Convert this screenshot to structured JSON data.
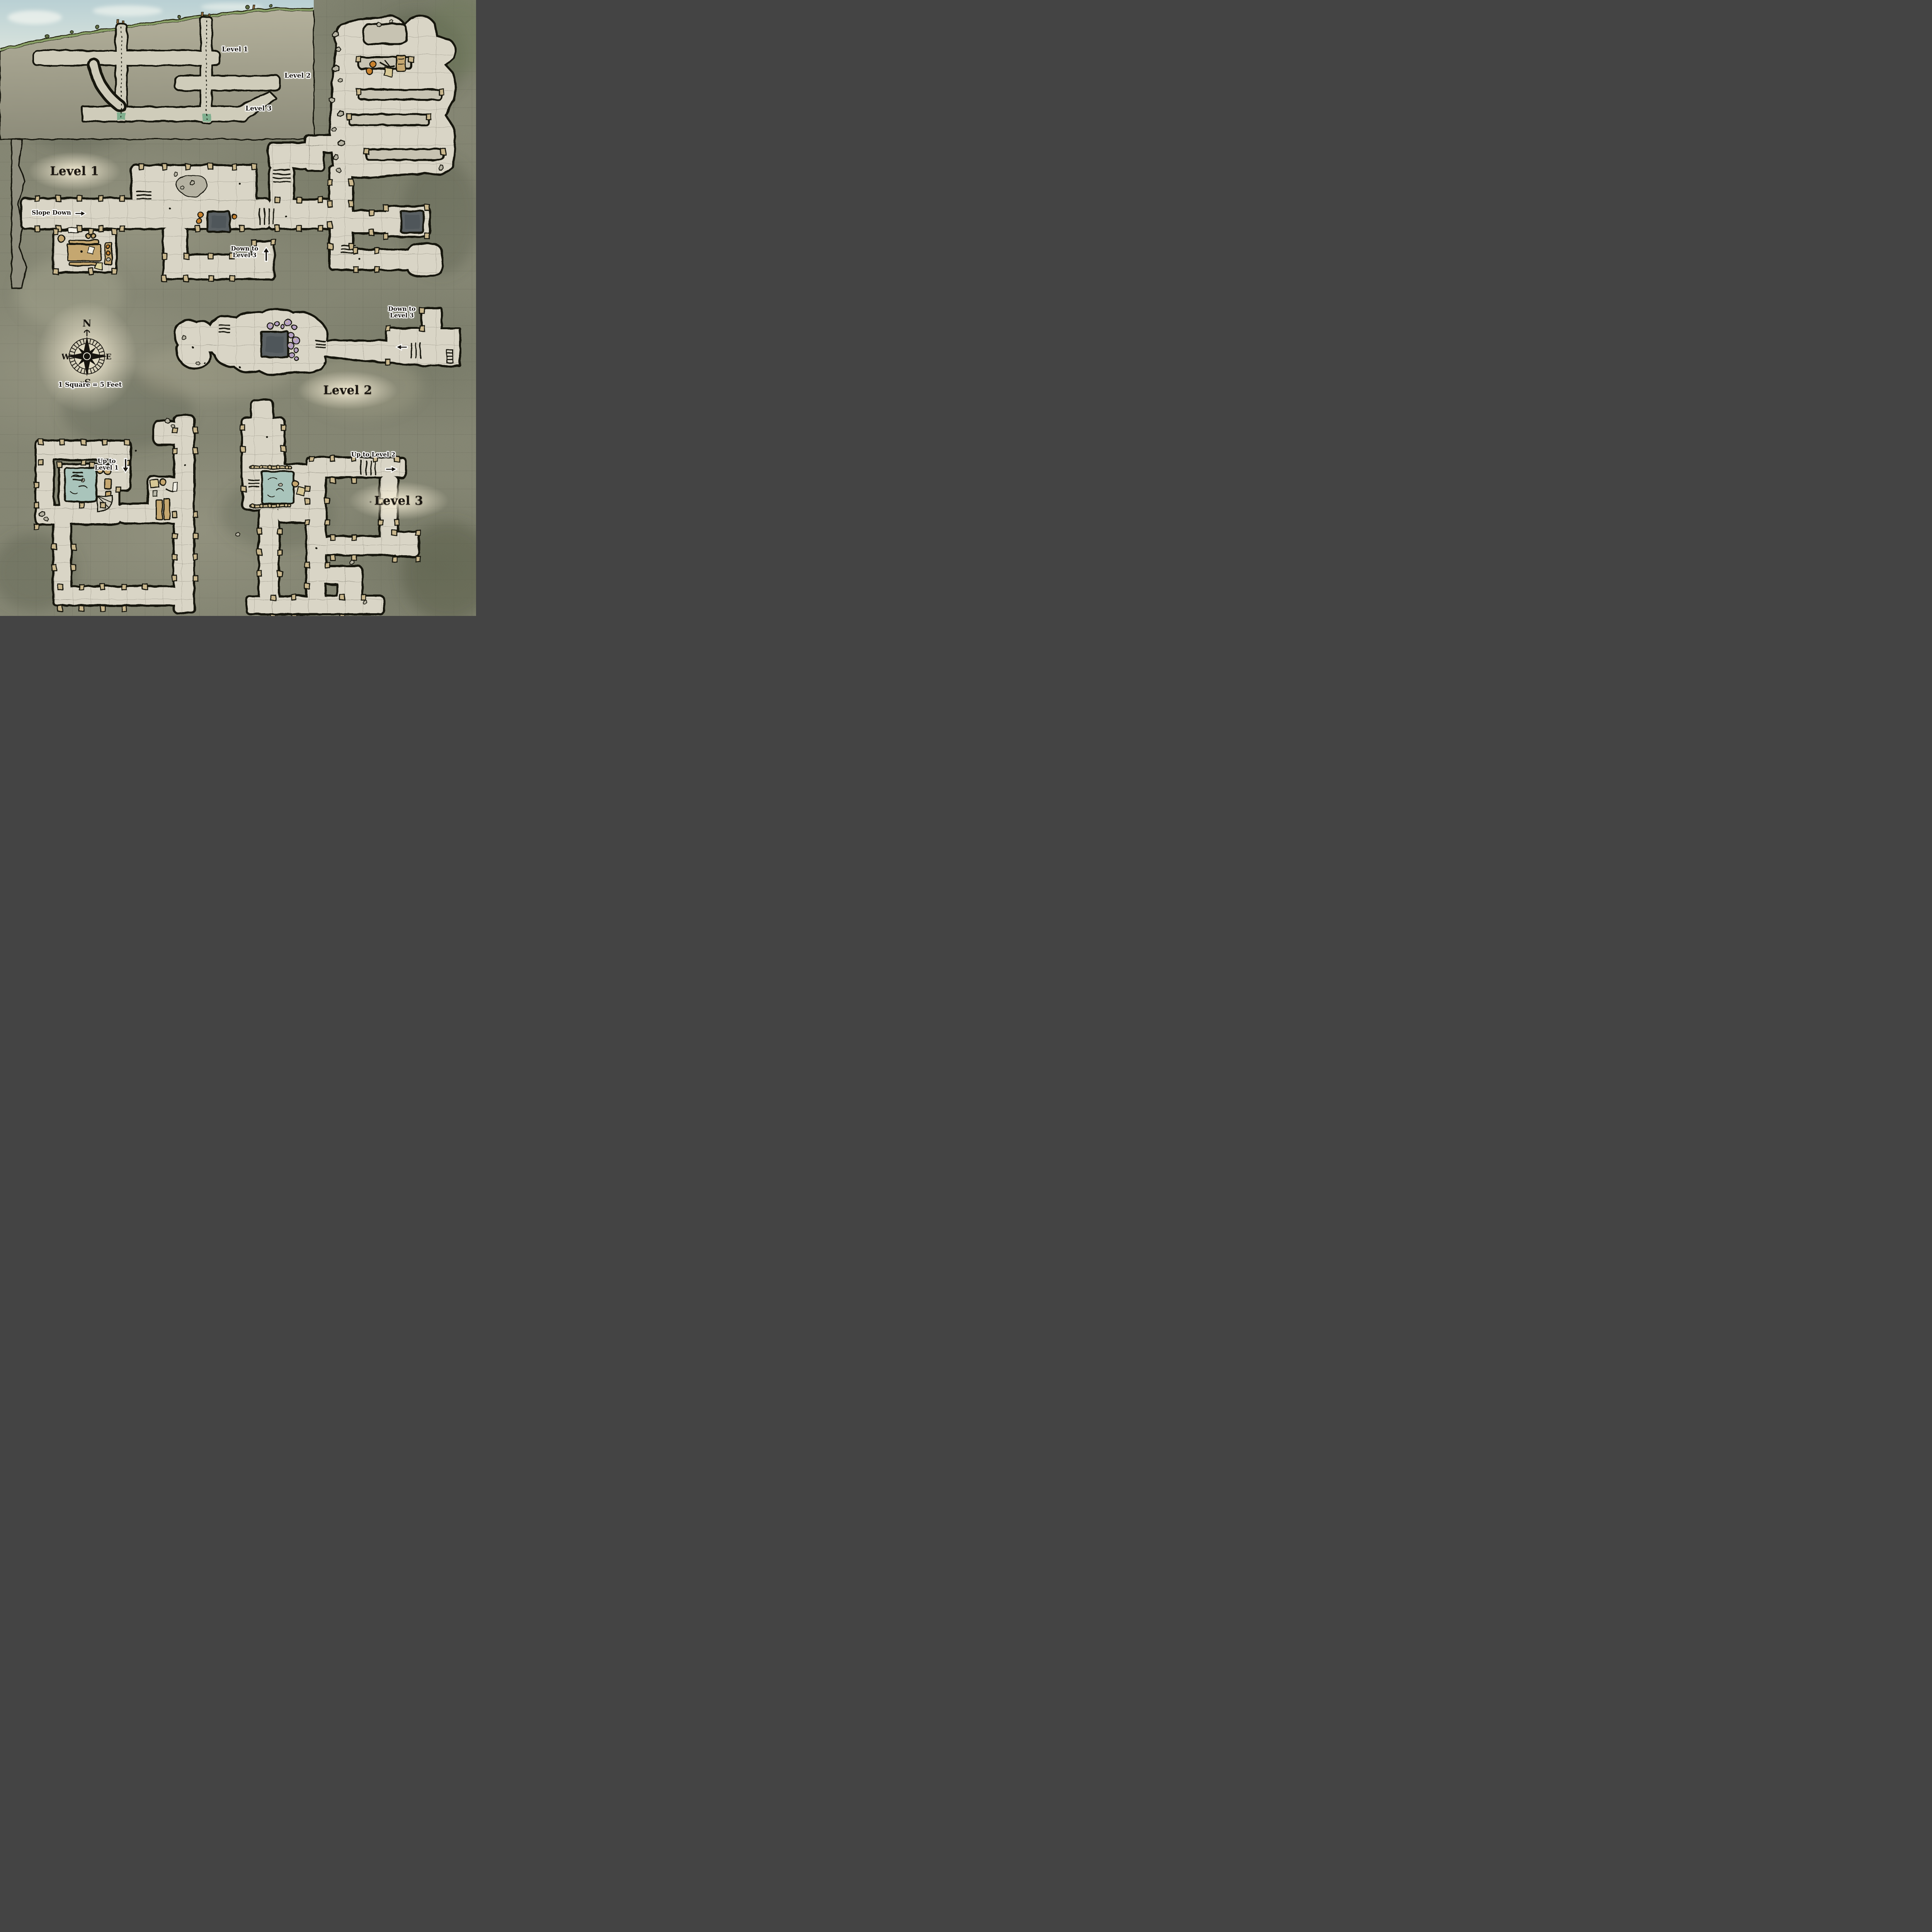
{
  "map": {
    "type": "three-level mine dungeon map",
    "view": "top-down floor plans with side cross-section"
  },
  "cross_section": {
    "level1_label": "Level 1",
    "level2_label": "Level 2",
    "level3_label": "Level 3"
  },
  "level1": {
    "title": "Level 1",
    "slope_down_label": "Slope Down",
    "down_to_level3": {
      "line1": "Down to",
      "line2": "Level 3"
    }
  },
  "level2": {
    "title": "Level 2",
    "down_to_level3": {
      "line1": "Down to",
      "line2": "Level 3"
    }
  },
  "level3": {
    "title": "Level 3",
    "up_to_level1": {
      "line1": "Up to",
      "line2": "Level 1"
    },
    "up_to_level2_label": "Up to Level 2"
  },
  "legend": {
    "scale_label": "1 Square = 5 Feet"
  },
  "compass": {
    "north": "N",
    "east": "E",
    "south": "S",
    "west": "W",
    "monogram": "M"
  },
  "colors": {
    "rock": "#81826f",
    "rock_dark": "#5d5f50",
    "floor": "#d9d5c6",
    "ink": "#17140f",
    "timber_post": "#c9b78d",
    "pit": "#5a6164",
    "pool_water": "#a9c4bb",
    "shaft_water": "#7fae8e",
    "grass": "#8ba268",
    "sky": "#bdd3d6",
    "mushroom": "#b5a0c3",
    "wood": "#c5a76f",
    "label_glow": "#f4ecd4",
    "rubble": "#b5b2a2"
  }
}
